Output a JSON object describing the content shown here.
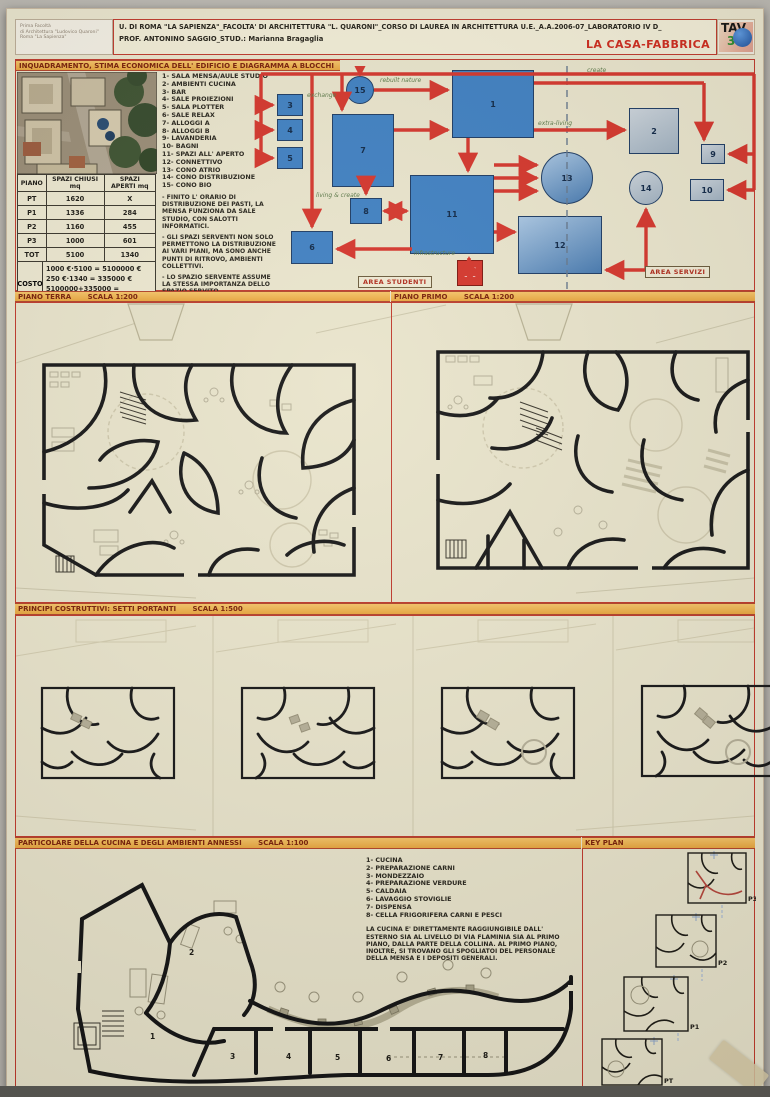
{
  "board": {
    "stamp": {
      "line1": "Prima Facoltà",
      "line2": "di Architettura \"Ludovico Quaroni\"",
      "line3": "Roma \"La Sapienza\""
    },
    "header_line1": "U. DI ROMA \"LA SAPIENZA\"_FACOLTA' DI ARCHITETTURA \"L. QUARONI\"_CORSO DI LAUREA  IN ARCHITETTURA U.E._A.A.2006-07_LABORATORIO IV D_",
    "header_line2": "PROF. ANTONINO SAGGIO_STUD.: Marianna Bragaglia",
    "project_title": "LA CASA-FABBRICA",
    "tav_label": "TAV",
    "tav_number": "3"
  },
  "sections": {
    "s1": "INQUADRAMENTO, STIMA ECONOMICA DELL' EDIFICIO E DIAGRAMMA A BLOCCHI",
    "s2_label": "PIANO TERRA",
    "s2_scale": "SCALA 1:200",
    "s3_label": "PIANO PRIMO",
    "s3_scale": "SCALA 1:200",
    "s4_label": "PRINCIPI COSTRUTTIVI: SETTI PORTANTI",
    "s4_scale": "SCALA 1:500",
    "s5_label": "PARTICOLARE DELLA CUCINA E DEGLI AMBIENTI ANNESSI",
    "s5_scale": "SCALA 1:100",
    "s6_label": "KEY PLAN"
  },
  "legend": {
    "items": [
      "1- SALA MENSA/AULE STUDIO",
      "2- AMBIENTI CUCINA",
      "3- BAR",
      "4- SALE PROIEZIONI",
      "5- SALA PLOTTER",
      "6- SALE RELAX",
      "7- ALLOGGI A",
      "8- ALLOGGI B",
      "9- LAVANDERIA",
      "10- BAGNI",
      "11- SPAZI ALL' APERTO",
      "12- CONNETTIVO",
      "13- CONO ATRIO",
      "14- CONO DISTRIBUZIONE",
      "15- CONO BIO"
    ],
    "notes": {
      "n1": "- FINITO L' ORARIO DI DISTRIBUZIONE DEI PASTI, LA MENSA FUNZIONA DA SALE STUDIO, CON SALOTTI INFORMATICI.",
      "n2": "- GLI SPAZI SERVENTI NON SOLO PERMETTONO LA DISTRIBUZIONE AI VARI PIANI, MA SONO ANCHE PUNTI DI RITROVO, AMBIENTI COLLETTIVI.",
      "n3": "- LO SPAZIO SERVENTE ASSUME LA STESSA IMPORTANZA DELLO SPAZIO SERVITO.",
      "n4a": "- GLI SPAZI APERTI SI TROVANO VERSO LA COLLINA. LA PIAZZA AL LIVELLO PIU' BASSO COLLEGA L' USCITA FLAMINIA DELLA METRO A",
      "n4b": "DIRETTAMENTE ALL' ATRIO DELL' EDIFICIO AL SECONDO LIVELLO."
    }
  },
  "table": {
    "headers": [
      "PIANO",
      "SPAZI CHIUSI mq",
      "SPAZI APERTI mq"
    ],
    "rows": [
      [
        "PT",
        "1620",
        "X"
      ],
      [
        "P1",
        "1336",
        "284"
      ],
      [
        "P2",
        "1160",
        "455"
      ],
      [
        "P3",
        "1000",
        "601"
      ],
      [
        "TOT",
        "5100",
        "1340"
      ]
    ],
    "costo_label": "COSTO",
    "costo_line1": "1000 €·5100 = 5100000 €",
    "costo_line2": "250 €·1340 = 335000 €",
    "costo_line3": "5100000+335000 =",
    "costo_total": "5435000 €"
  },
  "diagram": {
    "nodes": [
      "1",
      "2",
      "3",
      "4",
      "5",
      "6",
      "7",
      "8",
      "9",
      "10",
      "11",
      "12",
      "13",
      "14",
      "15"
    ],
    "annotations": {
      "exchange": "exchange",
      "rebuilt": "rebuilt nature",
      "create": "create",
      "extra": "extra-living",
      "living": "living & create",
      "infra": "infrastructure"
    },
    "area_studenti": "AREA STUDENTI",
    "area_servizi": "AREA SERVIZI",
    "metro_label": "M"
  },
  "kitchen": {
    "items": [
      "1- CUCINA",
      "2- PREPARAZIONE CARNI",
      "3- MONDEZZAIO",
      "4- PREPARAZIONE VERDURE",
      "5- CALDAIA",
      "6- LAVAGGIO STOVIGLIE",
      "7- DISPENSA",
      "8- CELLA FRIGORIFERA CARNI E PESCI"
    ],
    "paragraph": "LA CUCINA E' DIRETTAMENTE RAGGIUNGIBILE DALL' ESTERNO SIA AL LIVELLO DI VIA FLAMINIA SIA AL PRIMO PIANO, DALLA PARTE DELLA COLLINA. AL PRIMO PIANO, INOLTRE, SI TROVANO GLI SPOGLIATOI DEL PERSONALE DELLA MENSA E I DEPOSITI GENERALI.",
    "room_numbers": [
      "1",
      "2",
      "3",
      "4",
      "5",
      "6",
      "7",
      "8"
    ]
  },
  "keyplan": {
    "labels": [
      "P3",
      "P2",
      "P1",
      "PT"
    ]
  },
  "colors": {
    "accent_red": "#cf3a2e",
    "bar_orange": "#f0b65c",
    "node_blue": "#3f80c2",
    "node_gray": "#b3c0cc",
    "board_cream": "#eae5cd",
    "highlight_red": "#c0392b"
  }
}
